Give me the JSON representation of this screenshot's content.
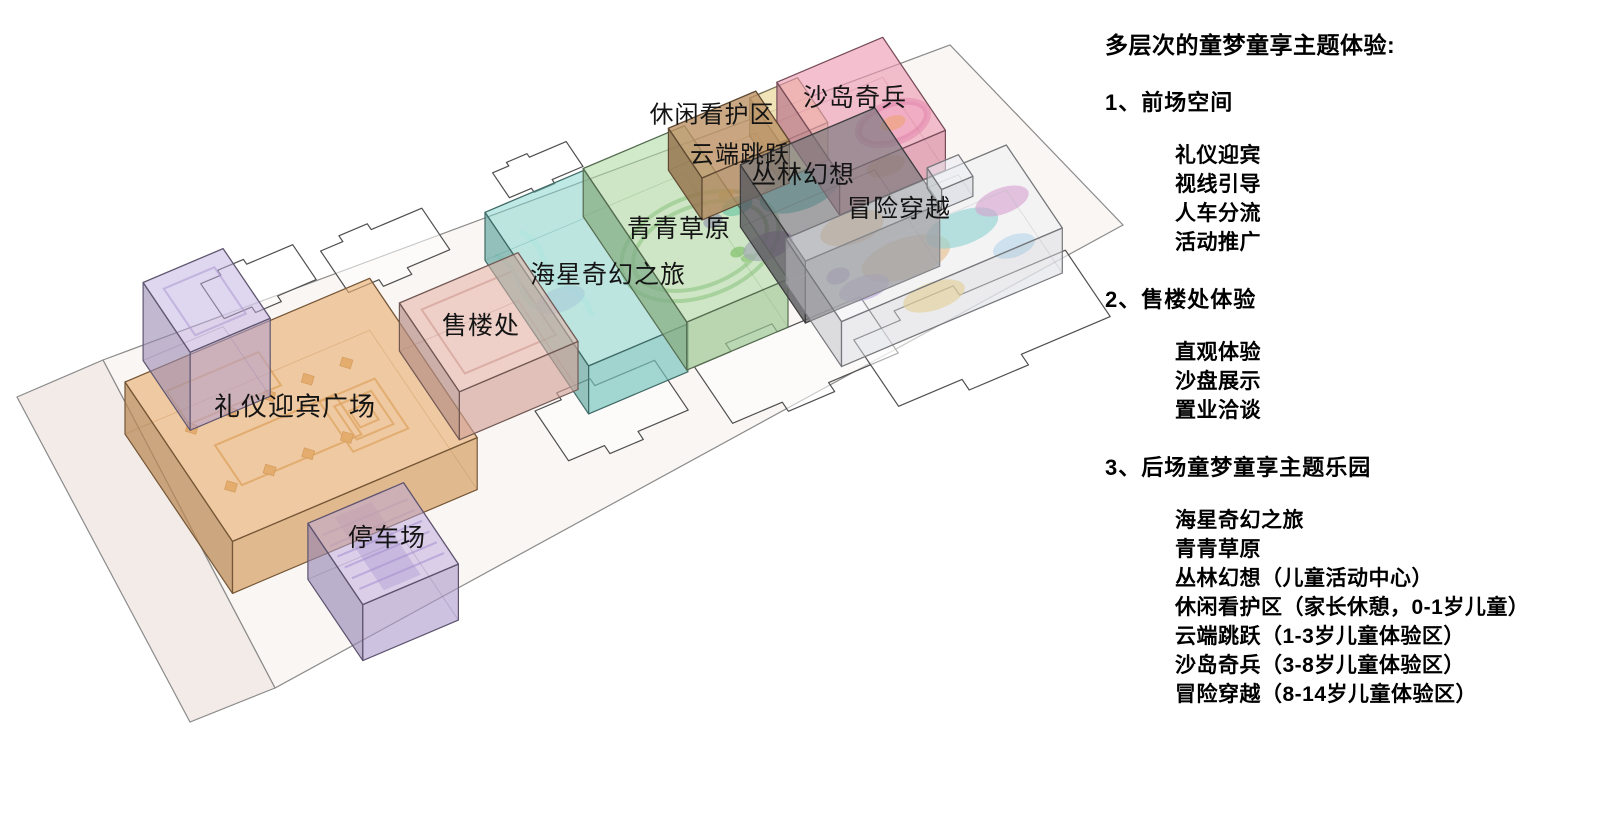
{
  "page": {
    "background": "#ffffff"
  },
  "diagram": {
    "zones": [
      {
        "id": "welcome-plaza",
        "label": "礼仪迎宾广场",
        "color": "#e9ad6d"
      },
      {
        "id": "sales-office",
        "label": "售楼处",
        "color": "#e4b0a6"
      },
      {
        "id": "parking",
        "label": "停车场",
        "color": "#b9a5dd"
      },
      {
        "id": "entry-cube",
        "label": "",
        "color": "#c0addf"
      },
      {
        "id": "starfish-journey",
        "label": "海星奇幻之旅",
        "color": "#7fd4cc"
      },
      {
        "id": "grassland",
        "label": "青青草原",
        "color": "#a9d89f"
      },
      {
        "id": "leisure-care",
        "label": "休闲看护区",
        "color": "#bd9264"
      },
      {
        "id": "cloud-jump",
        "label": "云端跳跃",
        "color": "#ecdca6"
      },
      {
        "id": "sand-island",
        "label": "沙岛奇兵",
        "color": "#ee9ab1"
      },
      {
        "id": "jungle-fantasy",
        "label": "丛林幻想",
        "color": "#77777b"
      },
      {
        "id": "adventure-cross",
        "label": "冒险穿越",
        "color": "#eceef5"
      }
    ]
  },
  "panel": {
    "title": "多层次的童梦童享主题体验:",
    "sections": [
      {
        "heading": "1、前场空间",
        "items": [
          "礼仪迎宾",
          "视线引导",
          "人车分流",
          "活动推广"
        ]
      },
      {
        "heading": "2、售楼处体验",
        "items": [
          "直观体验",
          "沙盘展示",
          "置业洽谈"
        ]
      },
      {
        "heading": "3、后场童梦童享主题乐园",
        "items": [
          "海星奇幻之旅",
          "青青草原",
          "丛林幻想（儿童活动中心）",
          "休闲看护区（家长休憩，0-1岁儿童）",
          "云端跳跃（1-3岁儿童体验区）",
          "沙岛奇兵（3-8岁儿童体验区）",
          "冒险穿越（8-14岁儿童体验区）"
        ]
      }
    ]
  }
}
